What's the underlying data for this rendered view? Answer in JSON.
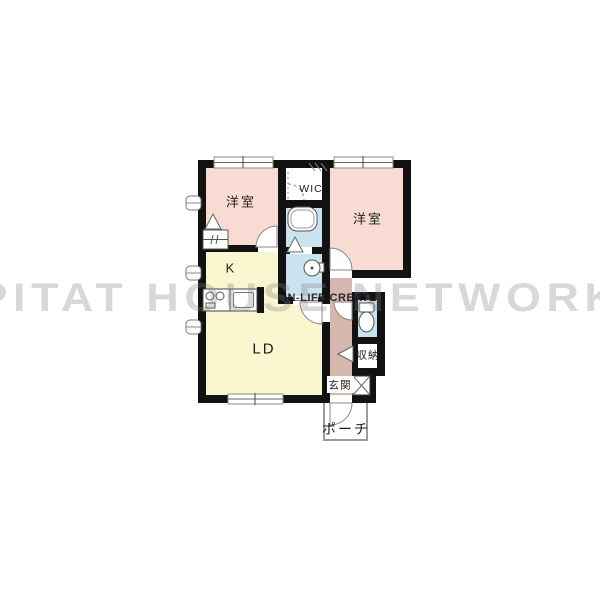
{
  "watermark": {
    "brand": "PITAT HOUSE NETWORK",
    "sub": "IN-LIFE CREATE"
  },
  "plan": {
    "rooms": [
      {
        "id": "bedroom-left",
        "label": "洋室"
      },
      {
        "id": "bedroom-right",
        "label": "洋室"
      },
      {
        "id": "wic",
        "label": "WIC"
      },
      {
        "id": "kitchen",
        "label": "K"
      },
      {
        "id": "living-dining",
        "label": "LD"
      },
      {
        "id": "entrance",
        "label": "玄関"
      },
      {
        "id": "storage",
        "label": "収納"
      },
      {
        "id": "porch",
        "label": "ポーチ"
      }
    ],
    "fixtures": [
      "bathtub",
      "washbasin",
      "toilet",
      "stove",
      "kitchen-sink",
      "closet",
      "shoe-box"
    ],
    "colors": {
      "bedroom": "#f8dcd4",
      "kitchen_living": "#faf6cf",
      "wet_area": "#cbe2f0",
      "hallway": "#d5b7ad",
      "wall": "#121212",
      "watermark_gray": "#aaaaaa"
    }
  }
}
